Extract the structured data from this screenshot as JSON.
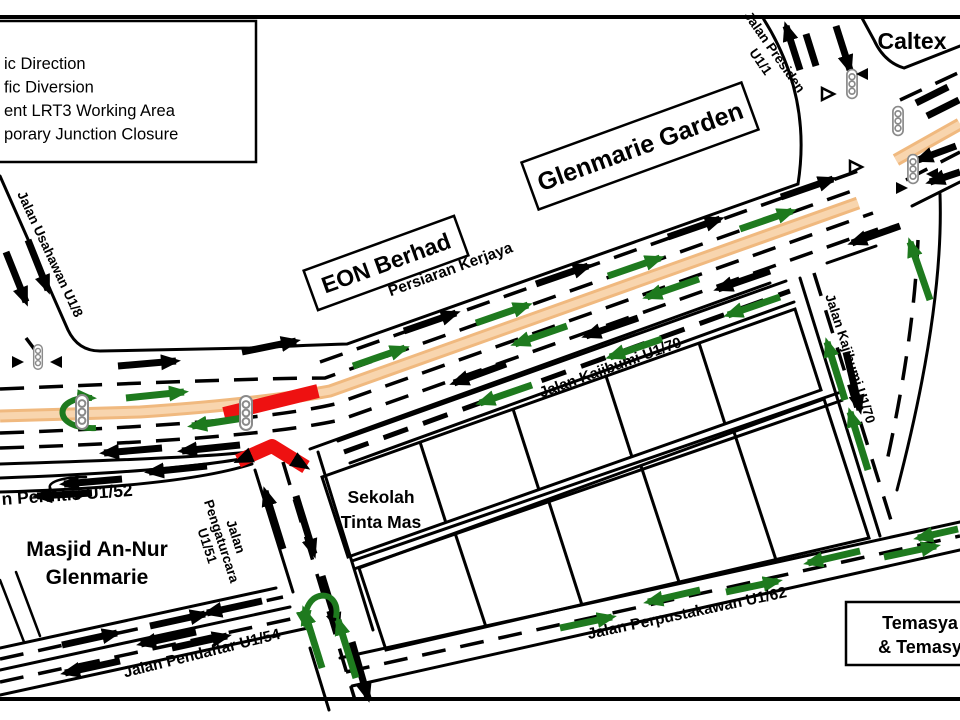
{
  "legend": {
    "items": [
      "ic Direction",
      "fic Diversion",
      "ent LRT3 Working Area",
      "porary Junction Closure"
    ]
  },
  "labels": {
    "caltex": "Caltex",
    "glenmarie_garden": "Glenmarie Garden",
    "eon_berhad": "EON Berhad",
    "persiaran_kerjaya": "Persiaran Kerjaya",
    "jalan_presiden_line1": "Jalan Presiden",
    "jalan_presiden_line2": "U1/1",
    "jalan_usahawan": "Jalan Usahawan  U1/8",
    "jalan_kajibumi_h": "Jalan Kajibumi  U1/70",
    "jalan_kajibumi_v": "Jalan Kajibumi U1/70",
    "jalan_perintis": "n Perintis U1/52",
    "pengaturcara_line1": "Jalan",
    "pengaturcara_line2": "Pengaturcara",
    "pengaturcara_line3": "U1/51",
    "masjid_line1": "Masjid  An-Nur",
    "masjid_line2": "Glenmarie",
    "sekolah_line1": "Sekolah",
    "sekolah_line2": "Tinta Mas",
    "jalan_pendaftar": "Jalan Pendaftar U1/54",
    "jalan_perpustakawan": "Jalan Perpustakawan  U1/62",
    "temasya_line1": "Temasya",
    "temasya_line2": "& Temasy"
  },
  "colors": {
    "diversion_green": "#1e7a1e",
    "closure_red": "#ee1111",
    "lrt3_orange": "#f0b97f",
    "lrt3_orange_light": "#f8d5ae",
    "road_black": "#000000"
  }
}
